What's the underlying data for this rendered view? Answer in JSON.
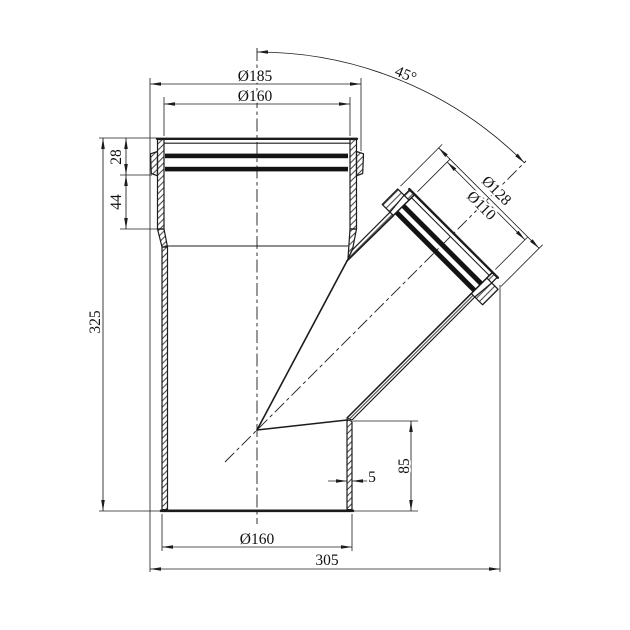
{
  "drawing": {
    "colors": {
      "background": "#ffffff",
      "line": "#1c1c1c",
      "seal_ring": "#141414"
    },
    "dimensions": {
      "top_socket_outer": "Ø185",
      "top_socket_inner": "Ø160",
      "branch_angle": "45°",
      "branch_socket_outer": "Ø128",
      "branch_socket_inner": "Ø110",
      "socket_collar_height": "28",
      "socket_depth": "44",
      "overall_height": "325",
      "wall_thickness": "5",
      "outlet_height": "85",
      "bottom_pipe_outer": "Ø160",
      "overall_width": "305"
    }
  }
}
